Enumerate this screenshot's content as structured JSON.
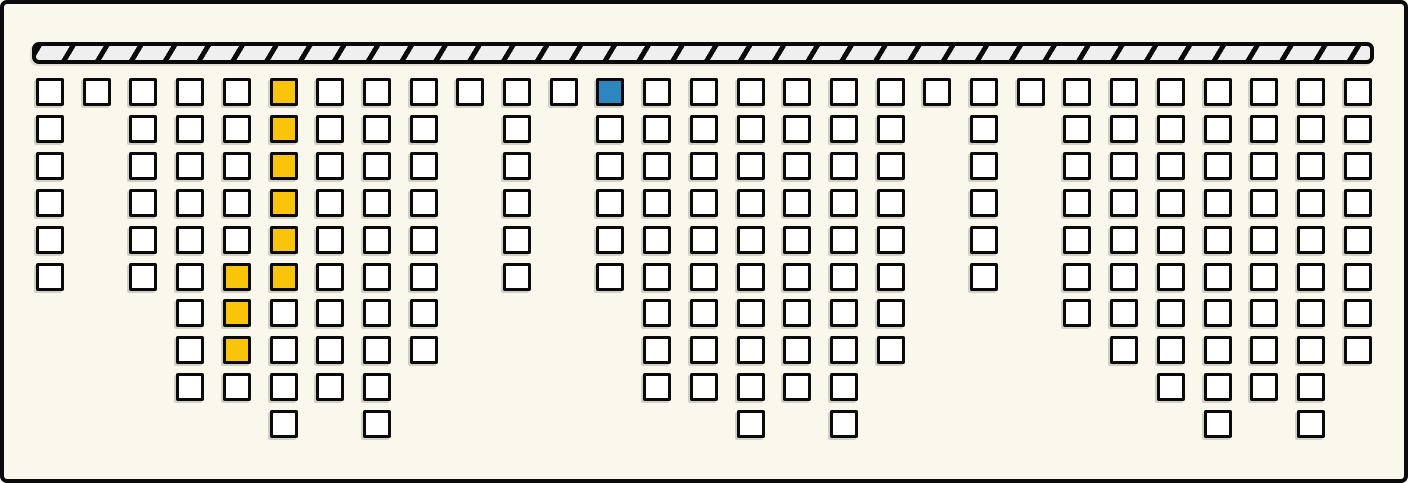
{
  "scene": {
    "kind": "hanging-block-grid",
    "colors": {
      "background": "#FAF8EC",
      "outline": "#0a0a0a",
      "cell_fill": "#FFFFFF",
      "highlight_yellow": "#FAC40A",
      "selected_blue": "#2E86C1",
      "ceiling_fill": "#EFEFEF"
    },
    "ceiling_bar": {
      "icon": "hatched-support-bar",
      "hatch_direction": "forward-slash"
    },
    "columns": [
      {
        "index": 1,
        "cells": 6
      },
      {
        "index": 2,
        "cells": 1
      },
      {
        "index": 3,
        "cells": 6
      },
      {
        "index": 4,
        "cells": 9
      },
      {
        "index": 5,
        "cells": 9,
        "yellow_rows": [
          6,
          7,
          8
        ]
      },
      {
        "index": 6,
        "cells": 10,
        "yellow_rows": [
          1,
          2,
          3,
          4,
          5,
          6
        ]
      },
      {
        "index": 7,
        "cells": 9
      },
      {
        "index": 8,
        "cells": 10
      },
      {
        "index": 9,
        "cells": 8
      },
      {
        "index": 10,
        "cells": 1
      },
      {
        "index": 11,
        "cells": 6
      },
      {
        "index": 12,
        "cells": 1
      },
      {
        "index": 13,
        "cells": 6,
        "blue_rows": [
          1
        ]
      },
      {
        "index": 14,
        "cells": 9
      },
      {
        "index": 15,
        "cells": 9
      },
      {
        "index": 16,
        "cells": 10
      },
      {
        "index": 17,
        "cells": 9
      },
      {
        "index": 18,
        "cells": 10
      },
      {
        "index": 19,
        "cells": 8
      },
      {
        "index": 20,
        "cells": 1
      },
      {
        "index": 21,
        "cells": 6
      },
      {
        "index": 22,
        "cells": 1
      },
      {
        "index": 23,
        "cells": 7
      },
      {
        "index": 24,
        "cells": 8
      },
      {
        "index": 25,
        "cells": 9
      },
      {
        "index": 26,
        "cells": 10
      },
      {
        "index": 27,
        "cells": 9
      },
      {
        "index": 28,
        "cells": 10
      },
      {
        "index": 29,
        "cells": 8
      }
    ]
  },
  "chart_data": {
    "type": "bar",
    "title": "",
    "xlabel": "",
    "ylabel": "",
    "orientation": "columns-hanging-from-top-bar",
    "categories": [
      1,
      2,
      3,
      4,
      5,
      6,
      7,
      8,
      9,
      10,
      11,
      12,
      13,
      14,
      15,
      16,
      17,
      18,
      19,
      20,
      21,
      22,
      23,
      24,
      25,
      26,
      27,
      28,
      29
    ],
    "values": [
      6,
      1,
      6,
      9,
      9,
      10,
      9,
      10,
      8,
      1,
      6,
      1,
      6,
      9,
      9,
      10,
      9,
      10,
      8,
      1,
      6,
      1,
      7,
      8,
      9,
      10,
      9,
      10,
      8
    ],
    "unit_square_grid": true,
    "grid": false,
    "legend": false,
    "highlighted_yellow_cells": [
      [
        5,
        6
      ],
      [
        5,
        7
      ],
      [
        5,
        8
      ],
      [
        6,
        1
      ],
      [
        6,
        2
      ],
      [
        6,
        3
      ],
      [
        6,
        4
      ],
      [
        6,
        5
      ],
      [
        6,
        6
      ]
    ],
    "selected_blue_cells": [
      [
        13,
        1
      ]
    ]
  }
}
